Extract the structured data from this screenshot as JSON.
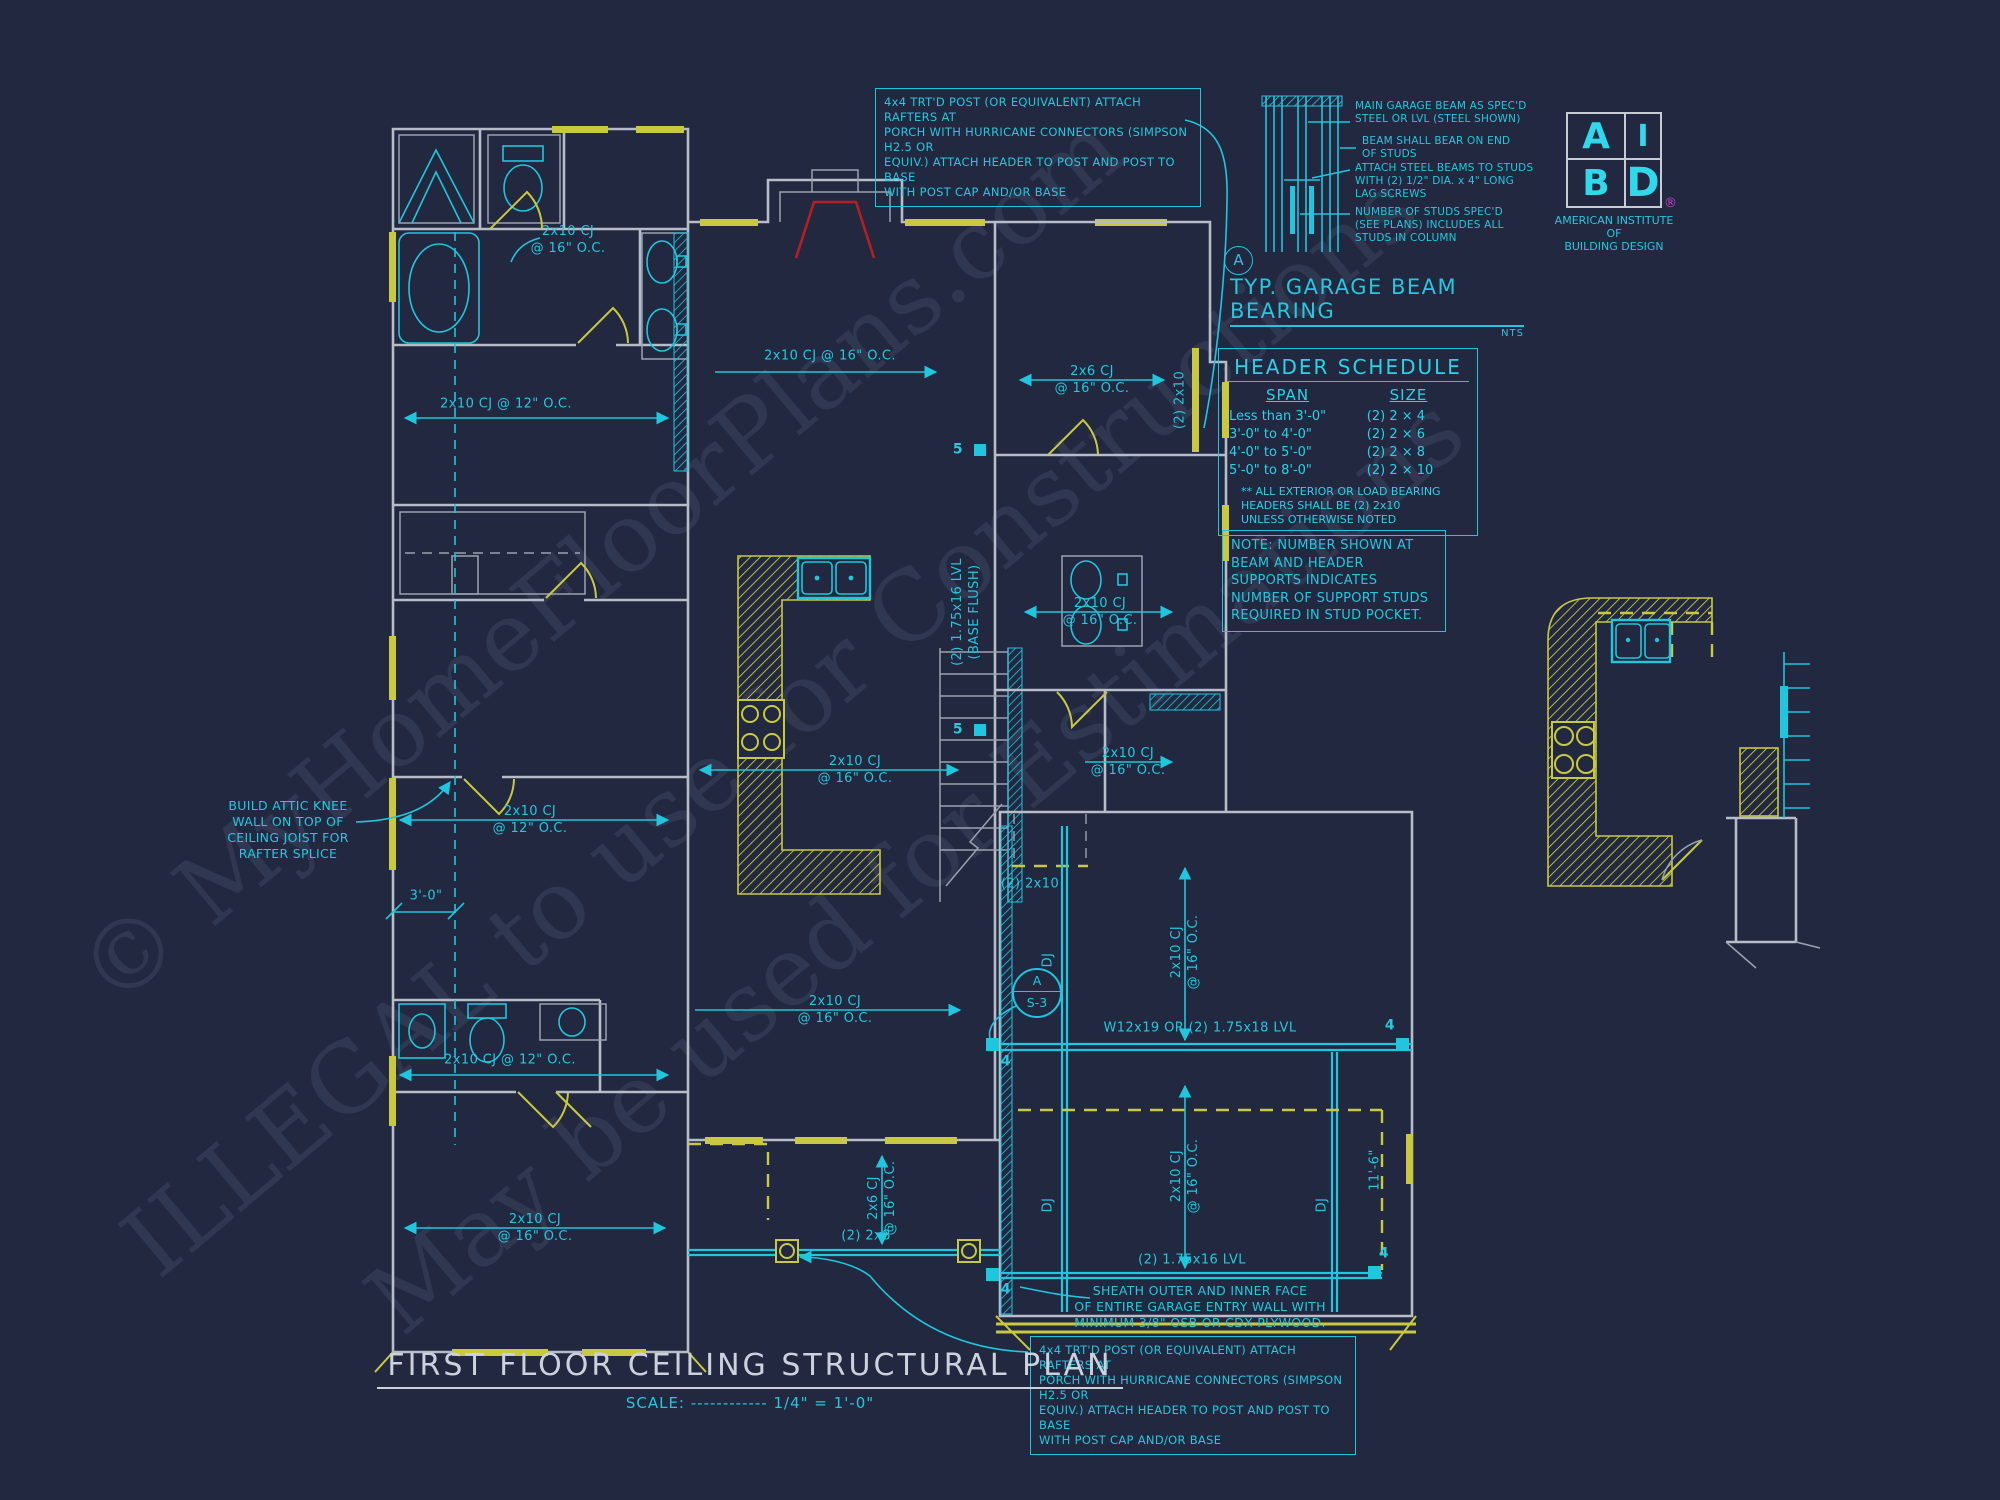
{
  "drawing": {
    "title": "FIRST FLOOR CEILING STRUCTURAL PLAN",
    "scale_prefix": "SCALE:",
    "scale_dots": "------------",
    "scale_value": "1/4\" = 1'-0\""
  },
  "colors": {
    "background": "#212840",
    "cyan": "#1fc6de",
    "yellow": "#c9c93f",
    "wall_gray": "#b6bcc8",
    "red": "#b51f24",
    "magenta": "#cf3ccf",
    "title_gray": "#ccd2dd"
  },
  "post_note": {
    "top": "4x4 TRT'D POST (OR EQUIVALENT) ATTACH RAFTERS AT\nPORCH WITH HURRICANE CONNECTORS (SIMPSON H2.5 OR\nEQUIV.) ATTACH HEADER TO POST AND POST TO BASE\nWITH POST CAP AND/OR BASE",
    "bottom": "4x4 TRT'D POST (OR EQUIVALENT) ATTACH RAFTERS AT\nPORCH WITH HURRICANE CONNECTORS (SIMPSON H2.5 OR\nEQUIV.) ATTACH HEADER TO POST AND POST TO BASE\nWITH POST CAP AND/OR BASE"
  },
  "knee_wall_note": "BUILD ATTIC KNEE\nWALL ON TOP OF\nCEILING JOIST FOR\nRAFTER SPLICE",
  "stud_note": "NOTE: NUMBER SHOWN AT\nBEAM AND HEADER\nSUPPORTS INDICATES\nNUMBER OF SUPPORT STUDS\nREQUIRED IN STUD POCKET.",
  "sheath_note": "SHEATH OUTER AND INNER FACE\nOF ENTIRE GARAGE ENTRY WALL WITH\nMINIMUM 3/8\" OSB OR CDX PLYWOOD.",
  "beam_detail": {
    "marker": "A",
    "title": "TYP. GARAGE BEAM BEARING",
    "scale": "NTS",
    "callouts": [
      "MAIN GARAGE BEAM AS SPEC'D\nSTEEL OR LVL (STEEL SHOWN)",
      "BEAM SHALL BEAR ON END\nOF STUDS",
      "ATTACH STEEL BEAMS TO STUDS\nWITH (2) 1/2\" DIA. x 4\" LONG\nLAG SCREWS",
      "NUMBER OF STUDS SPEC'D\n(SEE PLANS) INCLUDES ALL\nSTUDS IN COLUMN"
    ]
  },
  "header_schedule": {
    "title": "HEADER SCHEDULE",
    "columns": [
      "SPAN",
      "SIZE"
    ],
    "rows": [
      [
        "Less than 3'-0\"",
        "(2) 2 × 4"
      ],
      [
        "3'-0\" to 4'-0\"",
        "(2) 2 × 6"
      ],
      [
        "4'-0\" to 5'-0\"",
        "(2) 2 × 8"
      ],
      [
        "5'-0\" to 8'-0\"",
        "(2) 2 × 10"
      ]
    ],
    "footnote": "** ALL EXTERIOR OR LOAD BEARING\nHEADERS SHALL BE (2) 2x10\nUNLESS OTHERWISE NOTED"
  },
  "logo": {
    "q1": "A",
    "q2": "I",
    "q3": "B",
    "q4": "D",
    "registered": "®",
    "line1": "AMERICAN INSTITUTE",
    "line2": "OF",
    "line3": "BUILDING DESIGN"
  },
  "detail_bubble": {
    "top": "A",
    "bottom": "S-3"
  },
  "labels": [
    {
      "text": "2x10 CJ\n@ 16\" O.C."
    },
    {
      "text": "2x10 CJ @ 12\" O.C."
    },
    {
      "text": "2x10 CJ @ 16\" O.C."
    },
    {
      "text": "2x6 CJ\n@ 16\" O.C."
    },
    {
      "text": "(2) 2x10"
    },
    {
      "text": "(2) 1.75x16 LVL\n(BASE FLUSH)"
    },
    {
      "text": "2x10 CJ\n@ 16\" O.C."
    },
    {
      "text": "2x10 CJ\n@ 16\" O.C."
    },
    {
      "text": "2x10 CJ\n@ 16\" O.C."
    },
    {
      "text": "2x10 CJ\n@ 12\" O.C."
    },
    {
      "text": "3'-0\""
    },
    {
      "text": "2x10 CJ\n@ 16\" O.C."
    },
    {
      "text": "2x10 CJ @ 12\" O.C."
    },
    {
      "text": "2x10 CJ\n@ 16\" O.C."
    },
    {
      "text": "(2) 2x10"
    },
    {
      "text": "DJ"
    },
    {
      "text": "DJ"
    },
    {
      "text": "DJ"
    },
    {
      "text": "2x10 CJ\n@ 16\" O.C."
    },
    {
      "text": "W12x19 OR (2) 1.75x18 LVL"
    },
    {
      "text": "2x10 CJ\n@ 16\" O.C."
    },
    {
      "text": "11'-6\""
    },
    {
      "text": "(2) 1.75x16 LVL"
    },
    {
      "text": "2x6 CJ\n@ 16\" O.C."
    },
    {
      "text": "(2) 2x8"
    }
  ],
  "stud_counts": [
    "5",
    "5",
    "4",
    "4",
    "4",
    "4"
  ],
  "watermarks": [
    "© MyHomeFloorPlans.com",
    "ILLEGAL to use for Constructions",
    "May be used for Estimations"
  ]
}
